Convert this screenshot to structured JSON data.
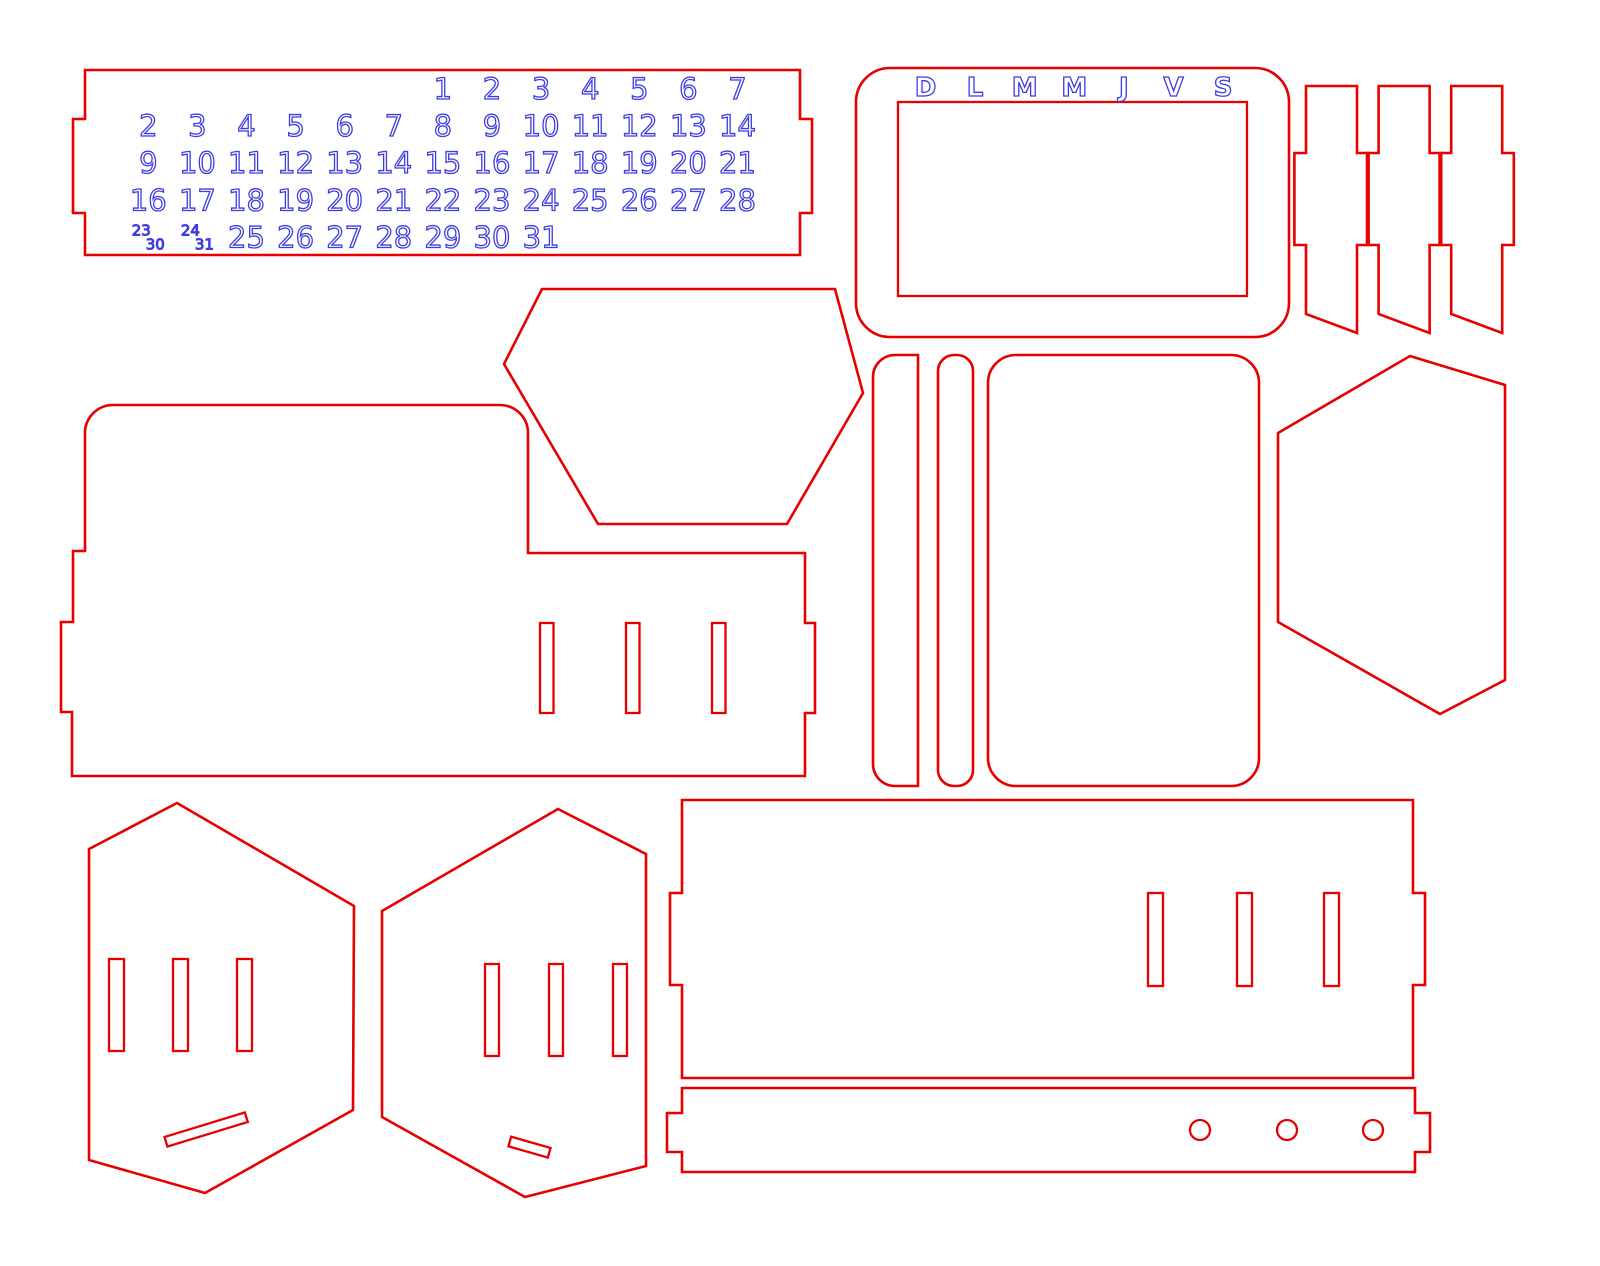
{
  "colors": {
    "cut_line": "#e60000",
    "engrave_text": "#3c3ce0",
    "engrave_fill": "#ffffff",
    "background": "#ffffff"
  },
  "calendar_plate": {
    "number_rows": [
      {
        "start_col": 6,
        "numbers": [
          "1",
          "2",
          "3",
          "4",
          "5",
          "6",
          "7"
        ]
      },
      {
        "start_col": 0,
        "numbers": [
          "2",
          "3",
          "4",
          "5",
          "6",
          "7",
          "8",
          "9",
          "10",
          "11",
          "12",
          "13",
          "14"
        ]
      },
      {
        "start_col": 0,
        "numbers": [
          "9",
          "10",
          "11",
          "12",
          "13",
          "14",
          "15",
          "16",
          "17",
          "18",
          "19",
          "20",
          "21"
        ]
      },
      {
        "start_col": 0,
        "numbers": [
          "16",
          "17",
          "18",
          "19",
          "20",
          "21",
          "22",
          "23",
          "24",
          "25",
          "26",
          "27",
          "28"
        ]
      },
      {
        "start_col": 2,
        "numbers": [
          "25",
          "26",
          "27",
          "28",
          "29",
          "30",
          "31"
        ]
      }
    ],
    "stacked_numbers": [
      {
        "col": 0,
        "row": 4,
        "top": "23",
        "bottom": "30"
      },
      {
        "col": 1,
        "row": 4,
        "top": "24",
        "bottom": "31"
      }
    ]
  },
  "weekday_plate": {
    "letters": [
      "D",
      "L",
      "M",
      "M",
      "J",
      "V",
      "S"
    ]
  }
}
